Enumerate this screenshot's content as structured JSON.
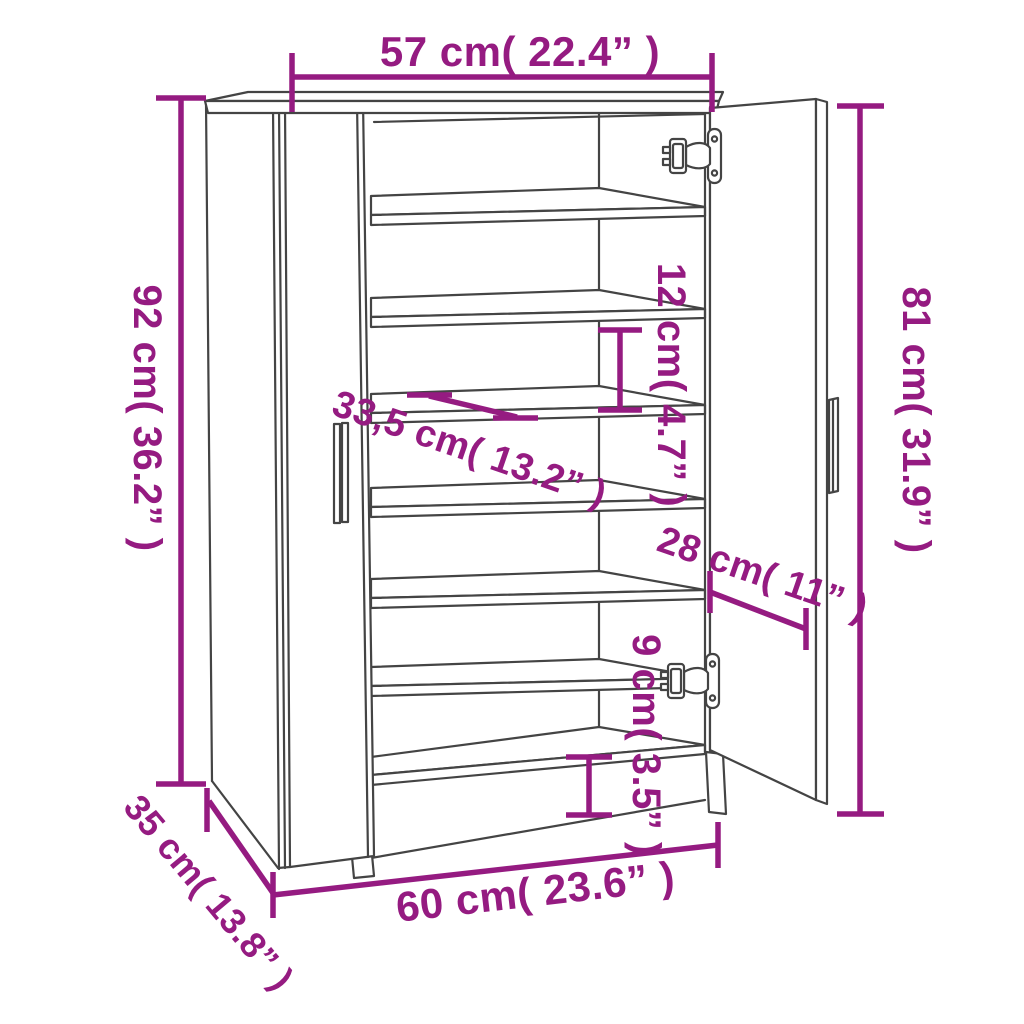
{
  "colors": {
    "dimension": "#951b81",
    "line": "#444444",
    "background": "#ffffff"
  },
  "dimensions": {
    "top_width": "57 cm( 22.4” )",
    "left_height": "92 cm( 36.2” )",
    "right_height": "81 cm( 31.9” )",
    "shelf_depth": "33,5 cm( 13.2” )",
    "shelf_spacing": "12 cm( 4.7” )",
    "door_width": "28 cm( 11” )",
    "base_height": "9 cm( 3.5” )",
    "bottom_width": "60 cm( 23.6” )",
    "side_depth": "35 cm( 13.8” )"
  }
}
